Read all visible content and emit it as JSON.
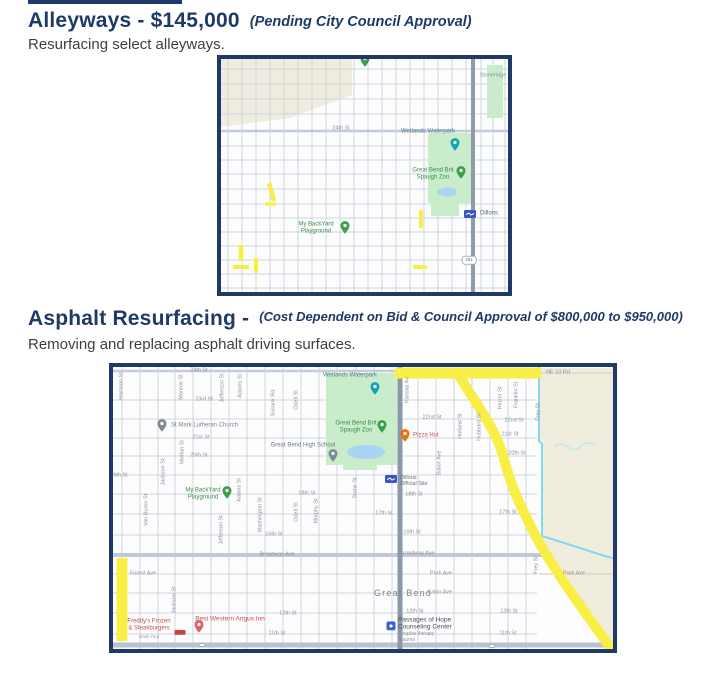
{
  "page": {
    "background": "#ffffff",
    "accent_navy": "#1f3a68",
    "highlight_yellow": "#f8ee46"
  },
  "sections": [
    {
      "title": "Alleyways - $145,000",
      "annotation": "(Pending City Council Approval)",
      "subtitle": "Resurfacing select alleyways."
    },
    {
      "title": "Asphalt Resurfacing -",
      "annotation": "(Cost Dependent on Bid & Council Approval of $800,000 to $950,000)",
      "subtitle": "Removing and replacing asphalt driving surfaces."
    }
  ],
  "maps": [
    {
      "id": "map1",
      "street_labels": [
        {
          "t": "24th St",
          "x": 120,
          "y": 70
        },
        {
          "t": "Stoneridge",
          "x": 272,
          "y": 17
        }
      ],
      "vertical_labels": [],
      "shields": [
        {
          "t": "281",
          "x": 248,
          "y": 201
        }
      ],
      "pois": [
        {
          "pin": {
            "x": 144,
            "y": 3,
            "color": "#3d9e4c",
            "type": "pin"
          }
        },
        {
          "label": {
            "lines": [
              "Wetlands Waterpark"
            ],
            "x": 207,
            "y": 73,
            "color": "#4e7e94",
            "size": 6
          },
          "pin": {
            "x": 234,
            "y": 87,
            "color": "#12a4b4",
            "type": "pin"
          }
        },
        {
          "label": {
            "lines": [
              "Great Bend Brit",
              "Spaugh Zoo"
            ],
            "x": 212,
            "y": 115,
            "color": "#3d8e4c",
            "size": 6
          },
          "pin": {
            "x": 240,
            "y": 115,
            "color": "#3d9e4c",
            "type": "pin"
          }
        },
        {
          "label": {
            "lines": [
              "My BackYard",
              "Playground"
            ],
            "x": 95,
            "y": 169,
            "color": "#3d8e4c",
            "size": 6
          },
          "pin": {
            "x": 124,
            "y": 170,
            "color": "#3d9e4c",
            "type": "pin"
          }
        },
        {
          "label": {
            "lines": [
              "Dillons"
            ],
            "x": 259,
            "y": 155,
            "color": "#5f6368",
            "size": 6,
            "align": "left"
          },
          "pin": {
            "x": 249,
            "y": 156,
            "color": "#3b55c0",
            "type": "dillons"
          }
        }
      ],
      "highlights": {
        "color": "#f8ee46",
        "segments": [
          {
            "x1": 48,
            "y1": 124,
            "x2": 53,
            "y2": 142,
            "w": 4.5
          },
          {
            "x1": 44,
            "y1": 145,
            "x2": 55,
            "y2": 145,
            "w": 3.5
          },
          {
            "x1": 200,
            "y1": 151,
            "x2": 200,
            "y2": 169,
            "w": 4
          },
          {
            "x1": 20,
            "y1": 186,
            "x2": 20,
            "y2": 202,
            "w": 4.5
          },
          {
            "x1": 35,
            "y1": 199,
            "x2": 35,
            "y2": 214,
            "w": 4
          },
          {
            "x1": 12,
            "y1": 208,
            "x2": 28,
            "y2": 208,
            "w": 4
          },
          {
            "x1": 192,
            "y1": 208,
            "x2": 206,
            "y2": 208,
            "w": 4
          }
        ],
        "paths": []
      }
    },
    {
      "id": "map2",
      "street_labels": [
        {
          "t": "24th St",
          "x": 86,
          "y": 4
        },
        {
          "t": "NE 10 Rd",
          "x": 445,
          "y": 6
        },
        {
          "t": "23rd St",
          "x": 91,
          "y": 33
        },
        {
          "t": "22nd St",
          "x": 319,
          "y": 51
        },
        {
          "t": "22nd St",
          "x": 401,
          "y": 54
        },
        {
          "t": "21st St",
          "x": 88,
          "y": 71
        },
        {
          "t": "21st St",
          "x": 397,
          "y": 68
        },
        {
          "t": "20th St",
          "x": 86,
          "y": 89
        },
        {
          "t": "20th St",
          "x": 404,
          "y": 87
        },
        {
          "t": "19th St",
          "x": 6,
          "y": 109
        },
        {
          "t": "18th St",
          "x": 194,
          "y": 127
        },
        {
          "t": "18th St",
          "x": 301,
          "y": 128
        },
        {
          "t": "17th St",
          "x": 271,
          "y": 147
        },
        {
          "t": "17th St",
          "x": 395,
          "y": 146
        },
        {
          "t": "16th St",
          "x": 161,
          "y": 168
        },
        {
          "t": "16th St",
          "x": 299,
          "y": 166
        },
        {
          "t": "Broadway Ave",
          "x": 164,
          "y": 188
        },
        {
          "t": "Broadway Ave",
          "x": 304,
          "y": 187
        },
        {
          "t": "Forest Ave",
          "x": 30,
          "y": 207
        },
        {
          "t": "Park Ave",
          "x": 328,
          "y": 207
        },
        {
          "t": "Park Ave",
          "x": 461,
          "y": 207
        },
        {
          "t": "Lakin Ave",
          "x": 327,
          "y": 226
        },
        {
          "t": "12th St",
          "x": 175,
          "y": 247
        },
        {
          "t": "12th St",
          "x": 302,
          "y": 245
        },
        {
          "t": "13th St",
          "x": 396,
          "y": 245
        },
        {
          "t": "11th St",
          "x": 164,
          "y": 267
        },
        {
          "t": "11th St",
          "x": 395,
          "y": 267
        }
      ],
      "vertical_labels": [
        {
          "t": "Harrison St",
          "x": 9,
          "y": 19
        },
        {
          "t": "Monroe St",
          "x": 69,
          "y": 20
        },
        {
          "t": "Jefferson St",
          "x": 110,
          "y": 21
        },
        {
          "t": "Adams St",
          "x": 128,
          "y": 19
        },
        {
          "t": "Susank Rd",
          "x": 161,
          "y": 36
        },
        {
          "t": "Odell St",
          "x": 184,
          "y": 33
        },
        {
          "t": "Kansas Av",
          "x": 295,
          "y": 23
        },
        {
          "t": "Heizer St",
          "x": 388,
          "y": 31
        },
        {
          "t": "Franklin St",
          "x": 404,
          "y": 28
        },
        {
          "t": "Frey St",
          "x": 426,
          "y": 45
        },
        {
          "t": "Holland St",
          "x": 348,
          "y": 59
        },
        {
          "t": "Hubbard St",
          "x": 367,
          "y": 60
        },
        {
          "t": "Morton St",
          "x": 70,
          "y": 85
        },
        {
          "t": "Baker Ave",
          "x": 327,
          "y": 96
        },
        {
          "t": "Jackson St",
          "x": 51,
          "y": 105
        },
        {
          "t": "Stone St",
          "x": 243,
          "y": 121
        },
        {
          "t": "Adams St",
          "x": 127,
          "y": 123
        },
        {
          "t": "Van Buren St",
          "x": 34,
          "y": 143
        },
        {
          "t": "Washington St",
          "x": 148,
          "y": 148
        },
        {
          "t": "Morphy St",
          "x": 204,
          "y": 144
        },
        {
          "t": "Odell St",
          "x": 184,
          "y": 145
        },
        {
          "t": "Jefferson St",
          "x": 109,
          "y": 163
        },
        {
          "t": "Frey St",
          "x": 424,
          "y": 198
        },
        {
          "t": "Jackson St",
          "x": 62,
          "y": 233
        }
      ],
      "shields": [
        {
          "t": "",
          "x": 89,
          "y": 278
        },
        {
          "t": "",
          "x": 379,
          "y": 279
        }
      ],
      "pois": [
        {
          "label": {
            "lines": [
              "St Mark Lutheran Church"
            ],
            "x": 58,
            "y": 59,
            "color": "#7d838b",
            "size": 6,
            "align": "left"
          },
          "pin": {
            "x": 49,
            "y": 60,
            "color": "#7e8b96",
            "type": "pin"
          }
        },
        {
          "label": {
            "lines": [
              "Wetlands Waterpark"
            ],
            "x": 237,
            "y": 9,
            "color": "#4e7e94",
            "size": 6
          },
          "pin": {
            "x": 262,
            "y": 23,
            "color": "#12a4b4",
            "type": "pin"
          }
        },
        {
          "label": {
            "lines": [
              "Great Bend Brit",
              "Spaugh Zoo"
            ],
            "x": 243,
            "y": 60,
            "color": "#3d8e4c",
            "size": 6
          },
          "pin": {
            "x": 269,
            "y": 61,
            "color": "#3d9e4c",
            "type": "pin"
          }
        },
        {
          "label": {
            "lines": [
              "Great Bend High School"
            ],
            "x": 190,
            "y": 79,
            "color": "#707a85",
            "size": 6
          },
          "pin": {
            "x": 220,
            "y": 90,
            "color": "#7e8b96",
            "type": "pin"
          }
        },
        {
          "label": {
            "lines": [
              "My BackYard",
              "Playground"
            ],
            "x": 90,
            "y": 127,
            "color": "#3d8e4c",
            "size": 6
          },
          "pin": {
            "x": 114,
            "y": 127,
            "color": "#3d9e4c",
            "type": "pin"
          }
        },
        {
          "label": {
            "lines": [
              "Pizza Hut"
            ],
            "x": 300,
            "y": 69,
            "color": "#c5584a",
            "size": 6,
            "align": "left"
          },
          "pin": {
            "x": 292,
            "y": 70,
            "color": "#e8710a",
            "type": "pin"
          }
        },
        {
          "label": {
            "lines": [
              "Dillons",
              "Official Site"
            ],
            "x": 287,
            "y": 114,
            "color": "#6a6f76",
            "size": 5.5,
            "align": "left"
          },
          "pin": {
            "x": 278,
            "y": 113,
            "color": "#3b55c0",
            "type": "dillons"
          }
        },
        {
          "label": {
            "lines": [
              "Great Bend"
            ],
            "x": 290,
            "y": 226,
            "color": "#7e858c",
            "size": 9,
            "ls": 1.2
          }
        },
        {
          "label": {
            "lines": [
              "Passages of Hope",
              "Counseling Center"
            ],
            "x": 285,
            "y": 257,
            "color": "#4a4f55",
            "size": 6.5,
            "align": "left"
          },
          "pin": {
            "x": 278,
            "y": 260,
            "color": "#3b62c9",
            "type": "square"
          },
          "sub": {
            "lines": [
              "Couples therapy",
              "Trauma"
            ],
            "x": 285,
            "y": 264,
            "size": 5
          }
        },
        {
          "label": {
            "lines": [
              "Best Western Angus Inn"
            ],
            "x": 117,
            "y": 252,
            "color": "#c0504d",
            "size": 6.5
          },
          "pin": {
            "x": 86,
            "y": 261,
            "color": "#e06070",
            "type": "pin"
          }
        },
        {
          "pin": {
            "x": 67,
            "y": 266,
            "color": "#c4453c",
            "type": "badge"
          }
        },
        {
          "label": {
            "lines": [
              "Freddy's Frozen",
              "& Steakburgers"
            ],
            "x": 36,
            "y": 258,
            "color": "#c0504d",
            "size": 6
          },
          "sub": {
            "lines": [
              "Grab Your"
            ],
            "x": 26,
            "y": 267,
            "size": 4.5
          }
        }
      ],
      "highlights": {
        "color": "#f8ee46",
        "segments": [
          {
            "x1": 282,
            "y1": 6,
            "x2": 428,
            "y2": 6,
            "w": 11
          },
          {
            "x1": 9,
            "y1": 191,
            "x2": 9,
            "y2": 274,
            "w": 11
          }
        ],
        "paths": [
          {
            "d": "M345,7 C365,40 383,62 391,92 C398,118 404,132 417,158 C436,196 462,232 497,280",
            "w": 10
          }
        ]
      }
    }
  ]
}
